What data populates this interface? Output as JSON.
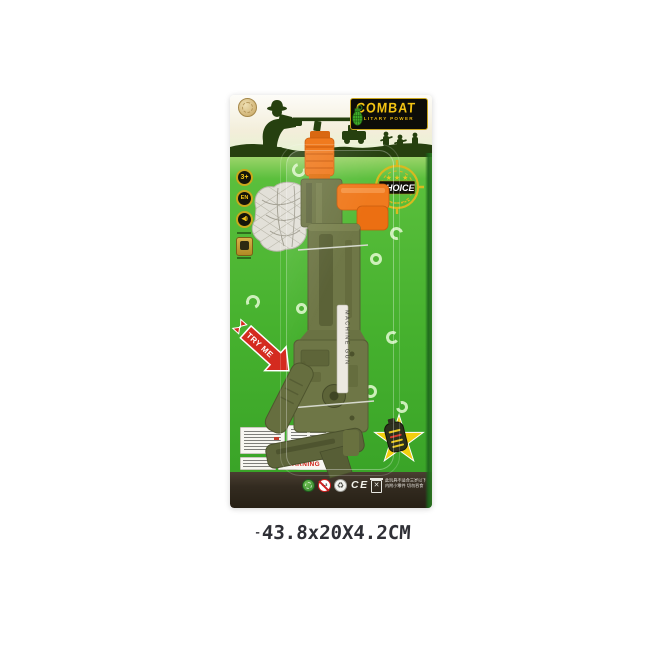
{
  "product": {
    "brand": "COMBAT",
    "brand_sub": "MILITARY POWER",
    "dimensions": "43.8x20X4.2CM",
    "dimensions_dash": "-"
  },
  "badges": {
    "age": "3+",
    "standard": "EN",
    "speaker": "◀))"
  },
  "target": {
    "stars": "★ ★ ★",
    "label": "CHOICE"
  },
  "gun": {
    "side_text": "MACHINE GUN"
  },
  "arrow": {
    "label": "TRY ME"
  },
  "labels": {
    "warning": "WARNING"
  },
  "strip": {
    "ce": "CE",
    "age_range": "0-3",
    "recycle": "♻",
    "cn_line1": "此玩具不适合三岁以下儿童使用",
    "cn_line2": "内附小零件 切勿吞食"
  },
  "colors": {
    "card_green": "#46b12e",
    "accent_orange": "#f07a1e",
    "gun_olive": "#6e7646",
    "logo_yellow": "#f3c413",
    "arrow_red": "#d42b1f",
    "star_yellow": "#f2cf0e"
  }
}
